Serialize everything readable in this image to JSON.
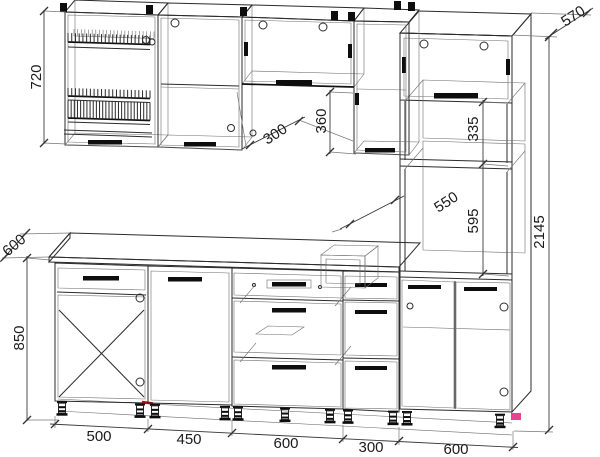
{
  "drawing": {
    "type": "kitchen-furniture-technical-drawing",
    "units": "mm"
  },
  "dims": {
    "wall_cabinet_height": "720",
    "worktop_depth": "600",
    "base_height": "850",
    "wall_cabinet_depth": "300",
    "gap_under_top_cabinet": "360",
    "microwave_niche_height": "335",
    "tall_unit_depth": "570",
    "oven_niche_width": "550",
    "oven_niche_height": "595",
    "total_height": "2145",
    "widths": [
      "500",
      "450",
      "600",
      "300",
      "600"
    ]
  },
  "colors": {
    "line": "#2b2b2b",
    "red_marker": "#c40000",
    "pink_marker": "#e84393",
    "background": "#ffffff"
  }
}
